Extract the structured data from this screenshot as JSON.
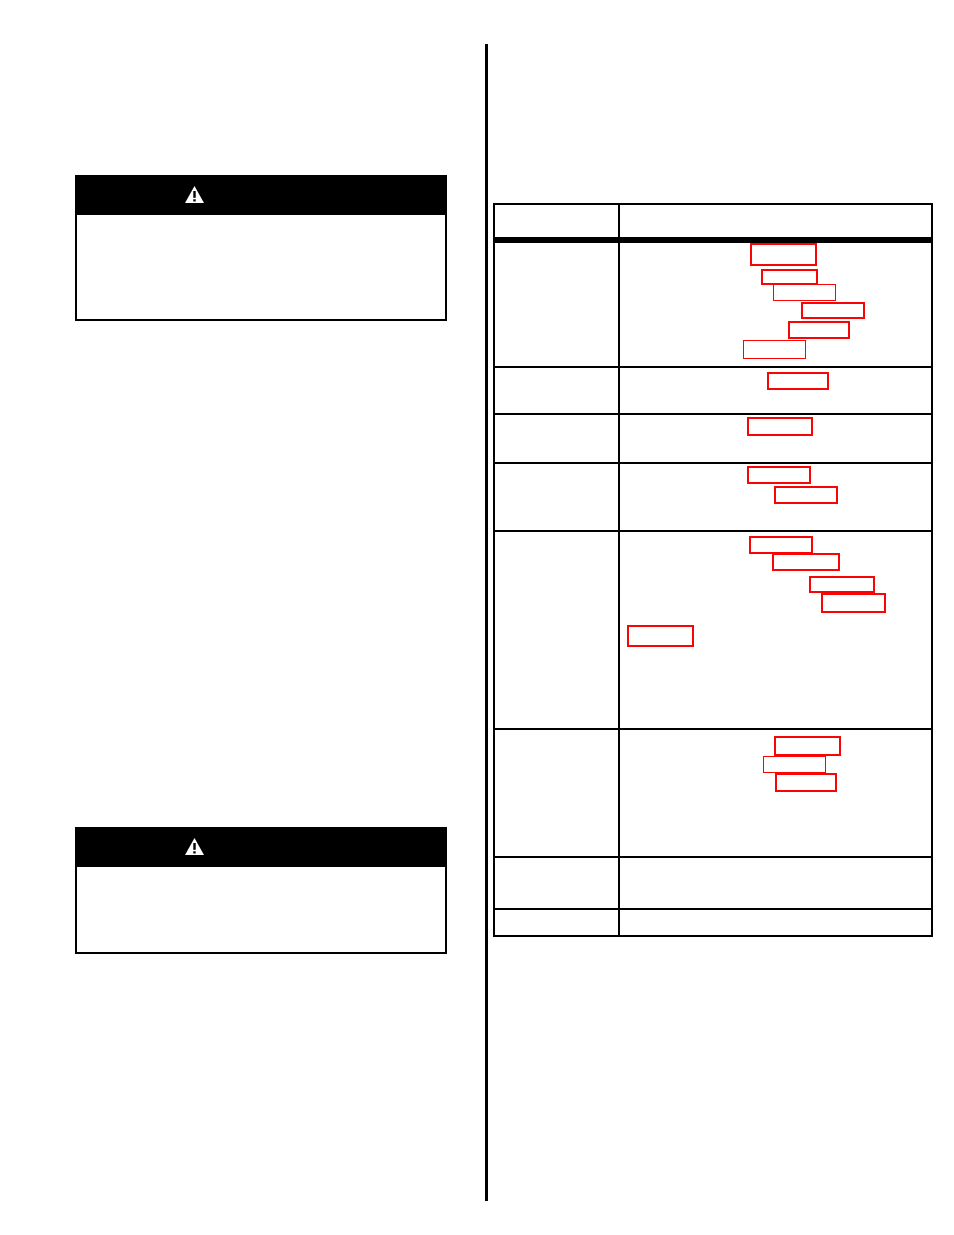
{
  "page": {
    "width": 954,
    "height": 1235,
    "background": "#ffffff"
  },
  "colors": {
    "ink": "#000000",
    "paper": "#ffffff",
    "redaction_border": "#fa0505"
  },
  "column_divider": {
    "x": 485,
    "y": 44,
    "width": 3,
    "height": 1157
  },
  "warning_blocks": [
    {
      "banner": {
        "x": 75,
        "y": 175,
        "width": 372,
        "height": 38
      },
      "icon": {
        "name": "warning-triangle-icon",
        "offset_left": 110,
        "width": 19,
        "height": 17
      },
      "body": {
        "x": 75,
        "y": 213,
        "width": 372,
        "height": 108,
        "border_width": 2
      }
    },
    {
      "banner": {
        "x": 75,
        "y": 827,
        "width": 372,
        "height": 38
      },
      "icon": {
        "name": "warning-triangle-icon",
        "offset_left": 110,
        "width": 19,
        "height": 17
      },
      "body": {
        "x": 75,
        "y": 865,
        "width": 372,
        "height": 89,
        "border_width": 2
      }
    }
  ],
  "table": {
    "x": 493,
    "y": 203,
    "width": 440,
    "height": 734,
    "outer_border_width": 2,
    "column_count": 2,
    "column_divider": {
      "left": 123,
      "width": 2
    },
    "header": {
      "height": 32,
      "rule_top": 32,
      "rule_thickness": 6
    },
    "row_dividers": [
      161,
      208,
      257,
      325,
      523,
      651,
      703
    ],
    "row_divider_thickness": 2,
    "body_row_count": 8
  },
  "redaction_boxes": {
    "items": [
      {
        "row": 1,
        "x": 750,
        "y": 243,
        "w": 67,
        "h": 23,
        "bw": 2
      },
      {
        "row": 1,
        "x": 761,
        "y": 269,
        "w": 57,
        "h": 16,
        "bw": 2
      },
      {
        "row": 1,
        "x": 773,
        "y": 284,
        "w": 63,
        "h": 17,
        "bw": 1.5
      },
      {
        "row": 1,
        "x": 801,
        "y": 302,
        "w": 64,
        "h": 17,
        "bw": 2.5
      },
      {
        "row": 1,
        "x": 788,
        "y": 321,
        "w": 62,
        "h": 18,
        "bw": 2.5
      },
      {
        "row": 1,
        "x": 743,
        "y": 340,
        "w": 63,
        "h": 19,
        "bw": 1.5
      },
      {
        "row": 2,
        "x": 767,
        "y": 372,
        "w": 62,
        "h": 18,
        "bw": 2
      },
      {
        "row": 3,
        "x": 747,
        "y": 417,
        "w": 66,
        "h": 19,
        "bw": 2
      },
      {
        "row": 4,
        "x": 747,
        "y": 466,
        "w": 64,
        "h": 18,
        "bw": 2.5
      },
      {
        "row": 4,
        "x": 774,
        "y": 486,
        "w": 64,
        "h": 18,
        "bw": 2
      },
      {
        "row": 5,
        "x": 749,
        "y": 536,
        "w": 64,
        "h": 18,
        "bw": 2
      },
      {
        "row": 5,
        "x": 772,
        "y": 553,
        "w": 68,
        "h": 18,
        "bw": 2.5
      },
      {
        "row": 5,
        "x": 809,
        "y": 576,
        "w": 66,
        "h": 17,
        "bw": 2
      },
      {
        "row": 5,
        "x": 821,
        "y": 593,
        "w": 65,
        "h": 20,
        "bw": 2
      },
      {
        "row": 5,
        "x": 627,
        "y": 625,
        "w": 67,
        "h": 22,
        "bw": 2.5
      },
      {
        "row": 6,
        "x": 774,
        "y": 736,
        "w": 67,
        "h": 20,
        "bw": 2.5
      },
      {
        "row": 6,
        "x": 763,
        "y": 756,
        "w": 63,
        "h": 17,
        "bw": 1.5
      },
      {
        "row": 6,
        "x": 775,
        "y": 773,
        "w": 62,
        "h": 19,
        "bw": 2.5
      }
    ]
  }
}
